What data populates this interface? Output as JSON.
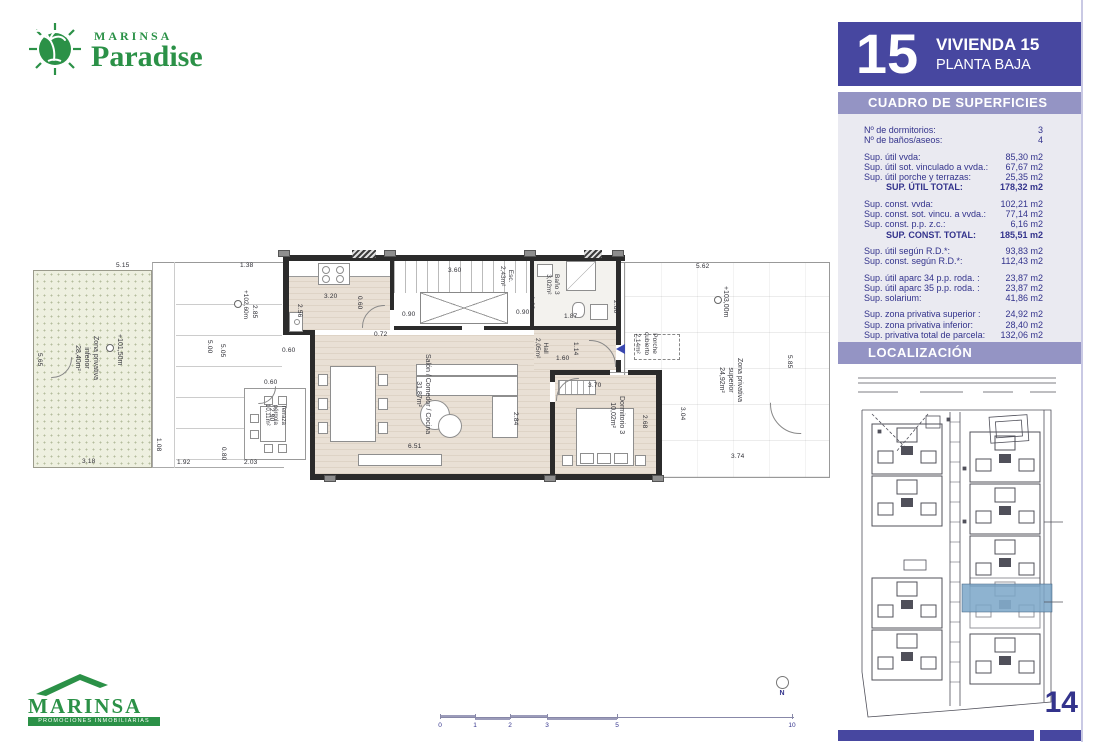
{
  "colors": {
    "green": "#2b9147",
    "accent": "#4747a0",
    "band": "#9494c4",
    "panel": "#eaeaf1",
    "ink": "#33338c",
    "hl": "#7aa6c8",
    "wall": "#2b2b2b",
    "floor": "#e9e0d5",
    "terr": "#eef0e0"
  },
  "brand_top": {
    "name": "MARINSA",
    "product": "Paradise"
  },
  "brand_bottom": {
    "name": "MARINSA",
    "tagline": "PROMOCIONES INMOBILIARIAS"
  },
  "header": {
    "number": "15",
    "title": "VIVIENDA 15",
    "subtitle": "PLANTA BAJA"
  },
  "surfaces": {
    "title": "CUADRO DE SUPERFICIES",
    "groups": [
      [
        [
          "Nº de dormitorios:",
          "3"
        ],
        [
          "Nº de baños/aseos:",
          "4"
        ]
      ],
      [
        [
          "Sup. útil vvda:",
          "85,30 m2"
        ],
        [
          "Sup. útil sot. vinculado a vvda.:",
          "67,67 m2"
        ],
        [
          "Sup. útil porche y terrazas:",
          "25,35 m2"
        ],
        [
          "SUP. ÚTIL TOTAL:",
          "178,32 m2",
          true
        ]
      ],
      [
        [
          "Sup. const. vvda:",
          "102,21 m2"
        ],
        [
          "Sup. const. sot. vincu. a vvda.:",
          "77,14 m2"
        ],
        [
          "Sup. const. p.p. z.c.:",
          "6,16 m2"
        ],
        [
          "SUP. CONST. TOTAL:",
          "185,51 m2",
          true
        ]
      ],
      [
        [
          "Sup. útil según R.D.*:",
          "93,83 m2"
        ],
        [
          "Sup. const. según R.D.*:",
          "112,43 m2"
        ]
      ],
      [
        [
          "Sup. útil aparc 34 p.p. roda. :",
          "23,87 m2"
        ],
        [
          "Sup. útil aparc 35 p.p. roda. :",
          "23,87 m2"
        ],
        [
          "Sup. solarium:",
          "41,86 m2"
        ]
      ],
      [
        [
          "Sup. zona privativa superior :",
          "24,92 m2"
        ],
        [
          "Sup. zona privativa inferior:",
          "28,40 m2"
        ],
        [
          "Sup. privativa total de parcela:",
          "132,06 m2"
        ]
      ]
    ]
  },
  "localizacion_title": "LOCALIZACIÓN",
  "page_number": "14",
  "plan": {
    "north": "N",
    "dims": [
      [
        "5.15",
        88,
        15,
        0
      ],
      [
        "1.38",
        212,
        15,
        0
      ],
      [
        "5.65",
        14,
        105,
        1
      ],
      [
        "5.00",
        184,
        92,
        1
      ],
      [
        "5.05",
        197,
        96,
        1
      ],
      [
        "2.85",
        229,
        57,
        1
      ],
      [
        "0.60",
        254,
        100,
        0
      ],
      [
        "3.20",
        296,
        46,
        0
      ],
      [
        "2.56",
        274,
        56,
        1
      ],
      [
        "0.60",
        334,
        48,
        1
      ],
      [
        "0.72",
        346,
        84,
        0
      ],
      [
        "3.60",
        420,
        20,
        0
      ],
      [
        "0.90",
        374,
        64,
        0
      ],
      [
        "0.90",
        488,
        62,
        0
      ],
      [
        "1.62",
        506,
        48,
        1
      ],
      [
        "1.87",
        536,
        66,
        0
      ],
      [
        "1.14",
        550,
        94,
        1
      ],
      [
        "1.60",
        528,
        108,
        0
      ],
      [
        "2.80",
        590,
        52,
        1
      ],
      [
        "3.70",
        560,
        135,
        0
      ],
      [
        "2.68",
        619,
        167,
        1
      ],
      [
        "3.04",
        657,
        159,
        1
      ],
      [
        "5.62",
        668,
        16,
        0
      ],
      [
        "5.85",
        764,
        107,
        1
      ],
      [
        "3.74",
        703,
        206,
        0
      ],
      [
        "3.14",
        286,
        161,
        1
      ],
      [
        "6.51",
        380,
        196,
        0
      ],
      [
        "2.84",
        490,
        164,
        1
      ],
      [
        "3.18",
        54,
        211,
        0
      ],
      [
        "1.92",
        149,
        212,
        0
      ],
      [
        "0.80",
        198,
        199,
        1
      ],
      [
        "2.03",
        216,
        212,
        0
      ],
      [
        "1.08",
        133,
        190,
        1
      ],
      [
        "0.60",
        236,
        132,
        0
      ],
      [
        "2.90",
        246,
        160,
        1
      ]
    ],
    "labels": [
      {
        "x": 72,
        "y": 88,
        "fs": 7,
        "lines": [
          "Zona privativa",
          "inferior",
          "28,40m²"
        ]
      },
      {
        "x": 258,
        "y": 156,
        "fs": 6,
        "lines": [
          "Terraza",
          "pérgola",
          "10,11m²"
        ]
      },
      {
        "x": 404,
        "y": 106,
        "fs": 7,
        "lines": [
          "Salón / Comedor / Cocina",
          "31,87m²"
        ]
      },
      {
        "x": 486,
        "y": 18,
        "fs": 6.5,
        "lines": [
          "Esc.",
          "2,43m²"
        ]
      },
      {
        "x": 532,
        "y": 26,
        "fs": 6.5,
        "lines": [
          "Baño 3",
          "3,02m²"
        ]
      },
      {
        "x": 521,
        "y": 90,
        "fs": 6.5,
        "lines": [
          "Hall",
          "2,05m²"
        ]
      },
      {
        "x": 630,
        "y": 84,
        "fs": 6.5,
        "lines": [
          "Porche",
          "cubierto",
          "2,14m²"
        ]
      },
      {
        "x": 598,
        "y": 148,
        "fs": 7,
        "lines": [
          "Dormitorio 3",
          "10,02m²"
        ]
      },
      {
        "x": 716,
        "y": 110,
        "fs": 7,
        "lines": [
          "Zona privativa",
          "superior",
          "24,92m²"
        ]
      },
      {
        "x": 96,
        "y": 86,
        "fs": 7,
        "lines": [
          "+101,50m"
        ]
      },
      {
        "x": 221,
        "y": 42,
        "fs": 6.5,
        "lines": [
          "+102,60m"
        ]
      },
      {
        "x": 702,
        "y": 38,
        "fs": 7,
        "lines": [
          "+103,00m"
        ]
      }
    ],
    "markers": [
      [
        78,
        96
      ],
      [
        206,
        52
      ],
      [
        686,
        48
      ]
    ],
    "scale_ticks": [
      [
        "0",
        0
      ],
      [
        "1",
        35
      ],
      [
        "2",
        70
      ],
      [
        "3",
        107
      ],
      [
        "5",
        177
      ],
      [
        "10",
        352
      ]
    ]
  }
}
